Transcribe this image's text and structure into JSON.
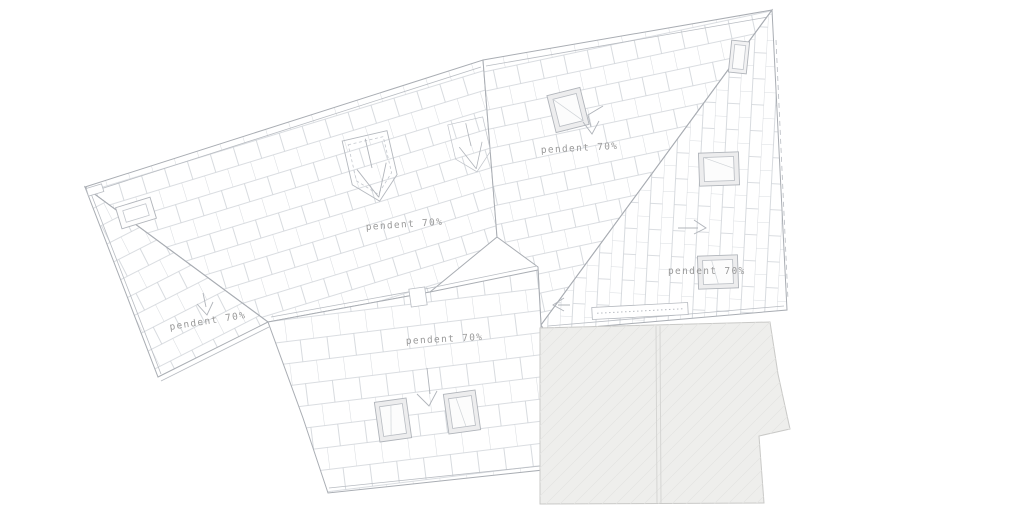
{
  "drawing": {
    "title": "roof-plan",
    "background_color": "#ffffff",
    "outline_color": "#a9adb3",
    "tile_line_color": "#ced2d7",
    "text_color": "#9a9a9a",
    "gray_volume_fill": "#eeeeec",
    "gray_volume_hatch": "#e5e5e3",
    "slope_labels": [
      {
        "plane": "upper-left",
        "text": "pendent 70%"
      },
      {
        "plane": "lower-left-strip",
        "text": "pendent 70%"
      },
      {
        "plane": "upper-middle",
        "text": "pendent 70%"
      },
      {
        "plane": "right",
        "text": "pendent 70%"
      },
      {
        "plane": "bottom-middle",
        "text": "pendent 70%"
      }
    ],
    "symbols": [
      "skylight-upper-middle",
      "skylight-right-small",
      "skylight-right-1",
      "skylight-right-2",
      "skylight-bottom-1",
      "skylight-bottom-2",
      "chimney-upper-left",
      "dormer-funnel-1",
      "dormer-funnel-2",
      "gutter-strip-right",
      "slope-arrow-down-a",
      "slope-arrow-down-b",
      "slope-arrow-down-d",
      "slope-arrow-right-c",
      "slope-arrow-left-c"
    ]
  }
}
